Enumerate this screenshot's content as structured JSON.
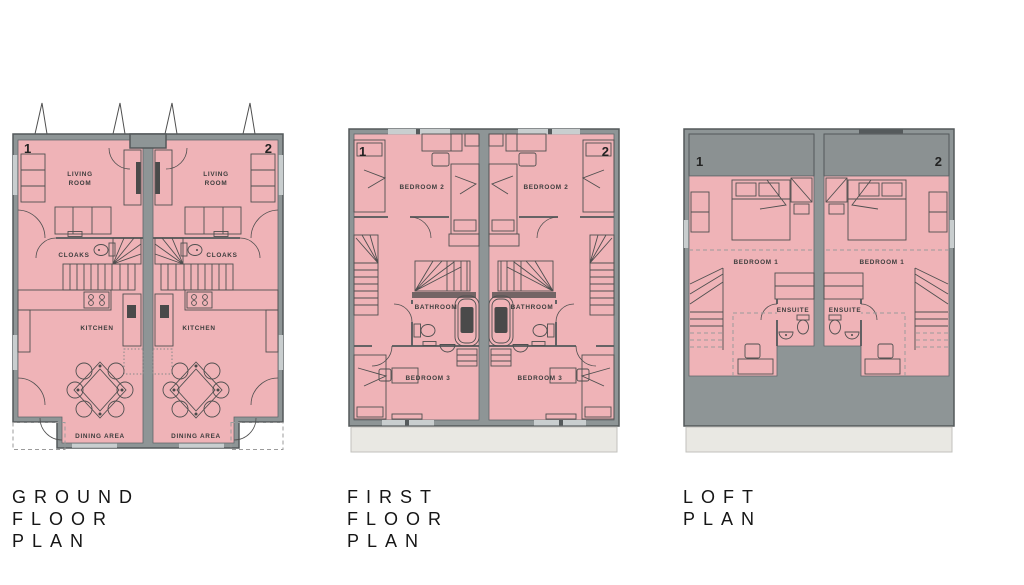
{
  "colors": {
    "room_fill": "#efb3b7",
    "wall_fill": "#8e9596",
    "wall_outline": "#53585a",
    "roof_fill": "#8b9192",
    "footprint_fill": "#e9e8e3",
    "furniture_line": "#4f4f4f",
    "label_color": "#3d3d3d",
    "dash_color": "#9b9b9b",
    "window_fill": "#c9cecf"
  },
  "plans": {
    "ground": {
      "title_lines": [
        "GROUND",
        "FLOOR",
        "PLAN"
      ],
      "unit_numbers": [
        "1",
        "2"
      ],
      "rooms": {
        "living_line1": "LIVING",
        "living_line2": "ROOM",
        "cloaks": "CLOAKS",
        "kitchen": "KITCHEN",
        "dining": "DINING AREA"
      }
    },
    "first": {
      "title_lines": [
        "FIRST",
        "FLOOR",
        "PLAN"
      ],
      "unit_numbers": [
        "1",
        "2"
      ],
      "rooms": {
        "bedroom2": "BEDROOM 2",
        "bathroom": "BATHROOM",
        "bedroom3": "BEDROOM 3"
      }
    },
    "loft": {
      "title_lines": [
        "LOFT",
        "PLAN"
      ],
      "unit_numbers": [
        "1",
        "2"
      ],
      "rooms": {
        "bedroom1": "BEDROOM 1",
        "ensuite": "ENSUITE"
      }
    }
  }
}
